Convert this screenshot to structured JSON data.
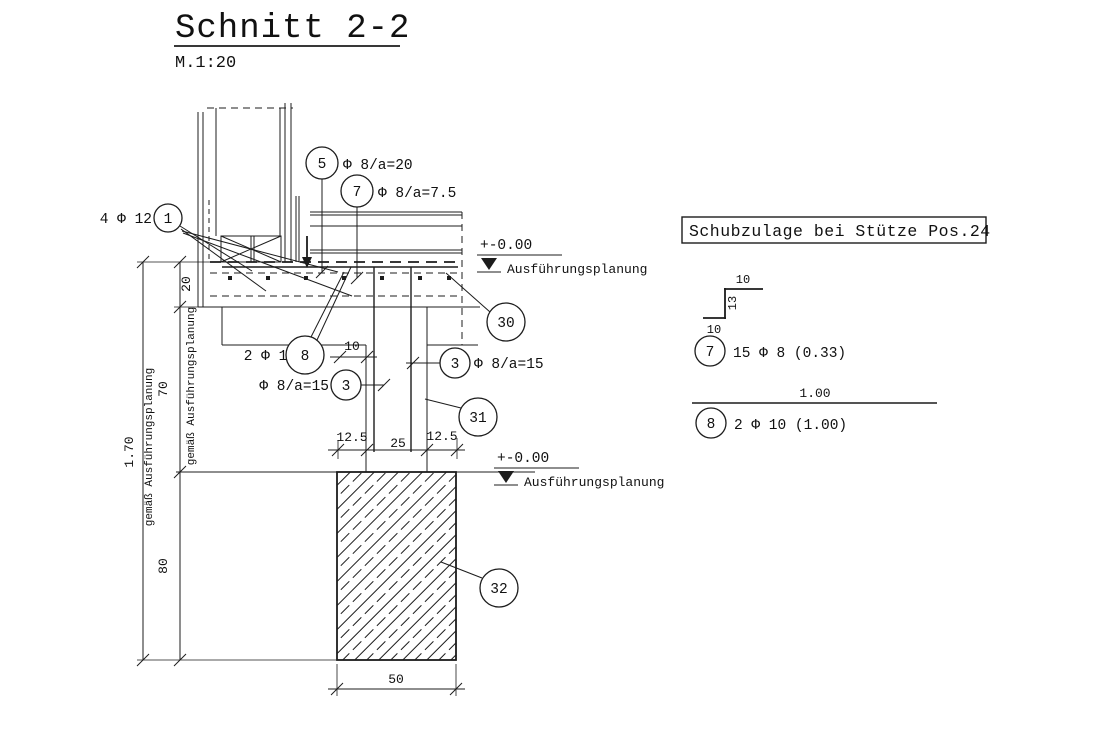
{
  "drawing": {
    "title": "Schnitt 2-2",
    "scale": "M.1:20"
  },
  "colors": {
    "line": "#1c1c1c",
    "background": "#ffffff"
  },
  "section": {
    "callouts": {
      "pos1": {
        "label": "1",
        "note": "4 Φ 12"
      },
      "pos5": {
        "label": "5",
        "note": "Φ 8/a=20"
      },
      "pos7": {
        "label": "7",
        "note": "Φ 8/a=7.5"
      },
      "pos8": {
        "label": "8",
        "note": "2 Φ 10"
      },
      "pos3_left": {
        "label": "3",
        "note": "Φ 8/a=15"
      },
      "pos3_right": {
        "label": "3",
        "note": "Φ 8/a=15"
      },
      "pos30": {
        "label": "30"
      },
      "pos31": {
        "label": "31"
      },
      "pos32": {
        "label": "32"
      }
    },
    "levels": {
      "slab": {
        "value": "+-0.00",
        "note": "Ausführungsplanung"
      },
      "foundation": {
        "value": "+-0.00",
        "note": "Ausführungsplanung"
      }
    },
    "dimensions": {
      "slab_thickness": "20",
      "beam_height": "70",
      "total_height": "1.70",
      "foundation_height": "80",
      "foundation_width": "50",
      "offset_left": "12.5",
      "column_width": "25",
      "offset_right": "12.5",
      "anchorage": "10",
      "note_outer": "gemäß Ausführungsplanung",
      "note_inner": "gemäß Ausführungsplanung"
    }
  },
  "detail": {
    "title": "Schubzulage bei Stütze Pos.24",
    "stirrup": {
      "callout": "7",
      "text": "15 Φ 8 (0.33)",
      "dim_top": "10",
      "dim_side": "13",
      "dim_bottom": "10"
    },
    "bar": {
      "callout": "8",
      "text": "2 Φ 10 (1.00)",
      "dim_length": "1.00"
    }
  }
}
